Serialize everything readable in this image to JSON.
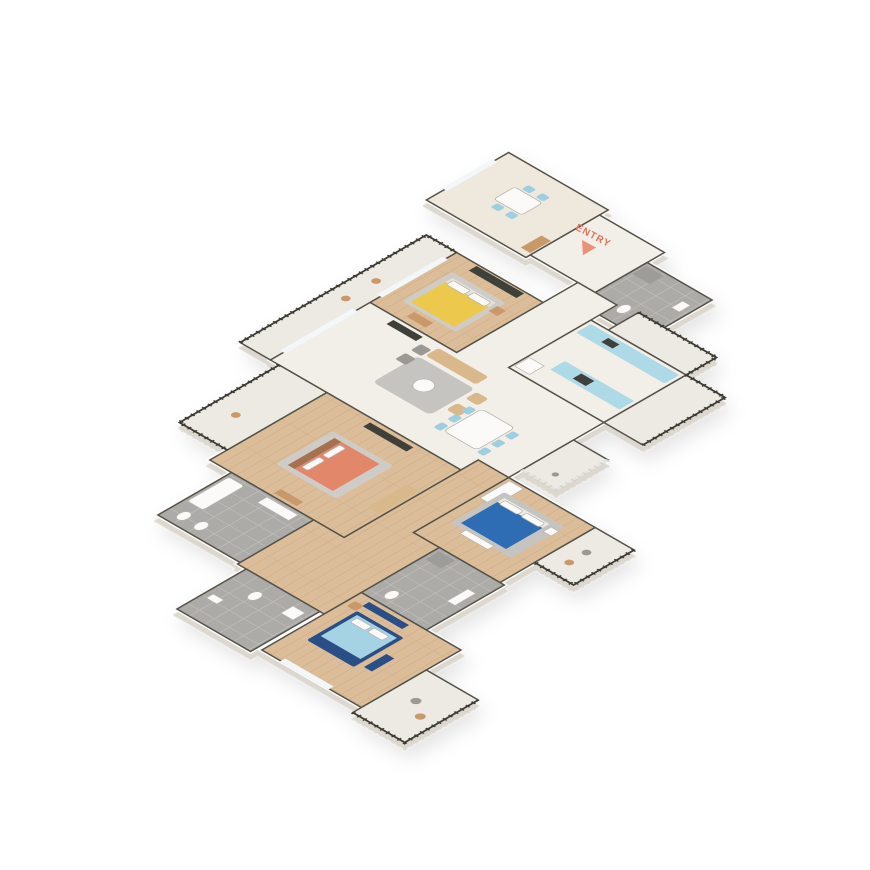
{
  "page": {
    "background": "#ffffff",
    "description_type": "isometric-3d-floorplan"
  },
  "watermark": {
    "text": "HOUSING"
  },
  "entry": {
    "label": "ENTRY",
    "color": "#e0755c",
    "arrow_color": "#e8927c"
  },
  "palette": {
    "wall_top": "#55524a",
    "wall_face": "#fdfcfa",
    "floor_marble": "#f2eee8",
    "floor_cream": "#efe8dd",
    "floor_wood": "#dcbd9a",
    "floor_tile": "#adaba8",
    "floor_balcony": "#edeae4",
    "railing_dark": "#3c3a33",
    "railing_white": "#e9e7e2",
    "rug_gray": "#c6c4c0",
    "rug_light": "#cfccc8",
    "sofa_tan": "#d9b98c",
    "wood_furniture": "#c9996a",
    "headboard_brown": "#a6714f",
    "bed_yellow": "#ecc84e",
    "bed_orange": "#e2876b",
    "bed_blue": "#2f6cb3",
    "bed_lightblue": "#a6d3e3",
    "bed_navy_frame": "#2b4f86",
    "chair_blue": "#9fcfdf",
    "counter_blue": "#aed9e6",
    "appliance_dark": "#3f3f3a",
    "fixture_white": "#fbfaf8",
    "pouf_gray": "#9b9994",
    "shower_gray": "#9e9c99"
  },
  "rooms": [
    {
      "id": "breakfast-room",
      "floor": "cream",
      "furniture": "table-4-chairs, cabinet"
    },
    {
      "id": "entry-foyer",
      "floor": "marble",
      "furniture": "entry-arrow"
    },
    {
      "id": "bathroom-top-right",
      "floor": "tile",
      "furniture": "shower, toilet, sink"
    },
    {
      "id": "utility-balcony",
      "floor": "balcony",
      "furniture": "railing"
    },
    {
      "id": "kitchen",
      "floor": "marble",
      "furniture": "two-blue-counters, fridge, sink, cooktop"
    },
    {
      "id": "terrace-right",
      "floor": "balcony",
      "furniture": "railing"
    },
    {
      "id": "bedroom-yellow",
      "floor": "wood",
      "furniture": "yellow-double-bed, tv-console, rug, bench"
    },
    {
      "id": "living-dining-hall",
      "floor": "marble",
      "furniture": "tan-sofa-set, poufs, rug, round-table, dining-table-6-blue-chairs"
    },
    {
      "id": "balcony-west-long",
      "floor": "balcony",
      "furniture": "chairs, railing"
    },
    {
      "id": "bedroom-orange",
      "floor": "wood",
      "furniture": "orange-double-bed, daybed, tv-console, bench"
    },
    {
      "id": "balcony-west-small",
      "floor": "balcony",
      "furniture": "chair, railing"
    },
    {
      "id": "bathroom-left",
      "floor": "tile",
      "furniture": "bathtub, vanity, toilet, bidet"
    },
    {
      "id": "bedroom-master-blue",
      "floor": "wood",
      "furniture": "blue-double-bed, wardrobe, rug, bench"
    },
    {
      "id": "balcony-master",
      "floor": "balcony",
      "furniture": "two-chairs, railing"
    },
    {
      "id": "balcony-dining",
      "floor": "balcony",
      "furniture": "white-railing, plant"
    },
    {
      "id": "corridor-bedrooms",
      "floor": "wood",
      "furniture": ""
    },
    {
      "id": "bathroom-middle",
      "floor": "tile",
      "furniture": "shower, toilet, vanity"
    },
    {
      "id": "bedroom-lightblue",
      "floor": "wood",
      "furniture": "lightblue-bed-navy-frame, navy-tv-console, navy-bench, chair"
    },
    {
      "id": "bathroom-bottom-left",
      "floor": "tile",
      "furniture": "toilet, vanity, washer"
    },
    {
      "id": "balcony-bottom",
      "floor": "balcony",
      "furniture": "two-chairs, railing"
    }
  ]
}
